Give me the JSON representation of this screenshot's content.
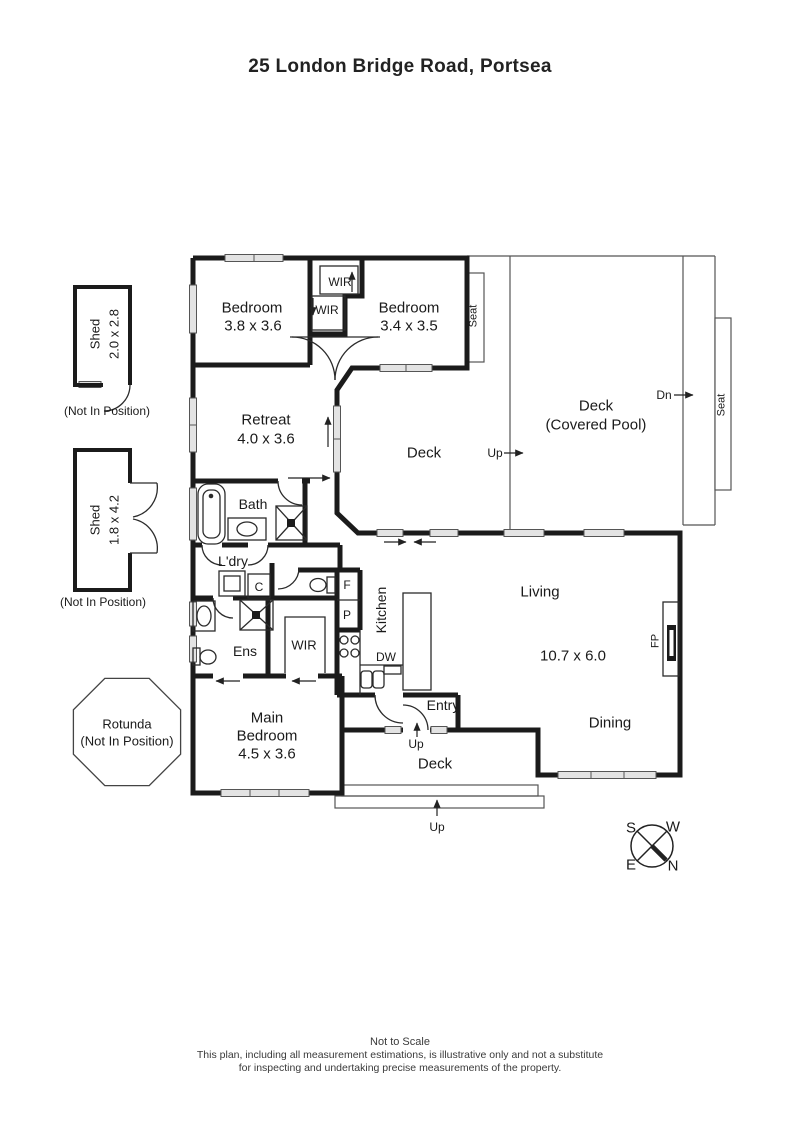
{
  "title": "25 London Bridge Road, Portsea",
  "colors": {
    "ink": "#1b1b1b"
  },
  "plan": {
    "labels": [
      {
        "name": "bedroom1-name",
        "text": "Bedroom",
        "x": 252,
        "y": 308,
        "size": 15
      },
      {
        "name": "bedroom1-dims",
        "text": "3.8 x 3.6",
        "x": 253,
        "y": 326,
        "size": 15
      },
      {
        "name": "wir-top-upper",
        "text": "WIR",
        "x": 340,
        "y": 282,
        "size": 12
      },
      {
        "name": "wir-top-lower",
        "text": "WIR",
        "x": 327,
        "y": 310,
        "size": 12
      },
      {
        "name": "bedroom2-name",
        "text": "Bedroom",
        "x": 409,
        "y": 308,
        "size": 15
      },
      {
        "name": "bedroom2-dims",
        "text": "3.4 x 3.5",
        "x": 409,
        "y": 326,
        "size": 15
      },
      {
        "name": "seat-top",
        "text": "Seat",
        "x": 474,
        "y": 316,
        "rot": -90,
        "size": 11
      },
      {
        "name": "deck-pool-name",
        "text": "Deck",
        "x": 596,
        "y": 406,
        "size": 15
      },
      {
        "name": "deck-pool-sub",
        "text": "(Covered Pool)",
        "x": 596,
        "y": 425,
        "size": 15
      },
      {
        "name": "dn-label",
        "text": "Dn",
        "x": 664,
        "y": 395,
        "size": 12
      },
      {
        "name": "seat-right",
        "text": "Seat",
        "x": 722,
        "y": 405,
        "rot": -90,
        "size": 11
      },
      {
        "name": "retreat-name",
        "text": "Retreat",
        "x": 266,
        "y": 420,
        "size": 15
      },
      {
        "name": "retreat-dims",
        "text": "4.0 x 3.6",
        "x": 266,
        "y": 439,
        "size": 15
      },
      {
        "name": "deck-middle",
        "text": "Deck",
        "x": 424,
        "y": 453,
        "size": 15
      },
      {
        "name": "up-middle",
        "text": "Up",
        "x": 495,
        "y": 453,
        "size": 12
      },
      {
        "name": "bath",
        "text": "Bath",
        "x": 253,
        "y": 504,
        "size": 14
      },
      {
        "name": "laundry",
        "text": "L'dry",
        "x": 233,
        "y": 561,
        "size": 14
      },
      {
        "name": "cupboard",
        "text": "C",
        "x": 259,
        "y": 587,
        "size": 12
      },
      {
        "name": "fridge",
        "text": "F",
        "x": 347,
        "y": 585,
        "size": 12
      },
      {
        "name": "pantry",
        "text": "P",
        "x": 347,
        "y": 615,
        "size": 12
      },
      {
        "name": "kitchen",
        "text": "Kitchen",
        "x": 381,
        "y": 610,
        "rot": -90,
        "size": 14
      },
      {
        "name": "dishwasher",
        "text": "DW",
        "x": 386,
        "y": 657,
        "size": 12
      },
      {
        "name": "wir-main",
        "text": "WIR",
        "x": 304,
        "y": 645,
        "size": 13
      },
      {
        "name": "ensuite",
        "text": "Ens",
        "x": 245,
        "y": 651,
        "size": 14
      },
      {
        "name": "main-bedroom-1",
        "text": "Main",
        "x": 267,
        "y": 718,
        "size": 15
      },
      {
        "name": "main-bedroom-2",
        "text": "Bedroom",
        "x": 267,
        "y": 736,
        "size": 15
      },
      {
        "name": "main-bedroom-dims",
        "text": "4.5 x 3.6",
        "x": 267,
        "y": 754,
        "size": 15
      },
      {
        "name": "entry",
        "text": "Entry",
        "x": 443,
        "y": 705,
        "size": 14
      },
      {
        "name": "up-entry",
        "text": "Up",
        "x": 416,
        "y": 744,
        "size": 12
      },
      {
        "name": "living",
        "text": "Living",
        "x": 540,
        "y": 592,
        "size": 15
      },
      {
        "name": "living-dims",
        "text": "10.7 x 6.0",
        "x": 573,
        "y": 656,
        "size": 15
      },
      {
        "name": "dining",
        "text": "Dining",
        "x": 610,
        "y": 723,
        "size": 15
      },
      {
        "name": "fireplace",
        "text": "FP",
        "x": 656,
        "y": 641,
        "rot": -90,
        "size": 11
      },
      {
        "name": "deck-bottom",
        "text": "Deck",
        "x": 435,
        "y": 764,
        "size": 15
      },
      {
        "name": "up-deck",
        "text": "Up",
        "x": 437,
        "y": 827,
        "size": 12
      },
      {
        "name": "shed1-name",
        "text": "Shed",
        "x": 95,
        "y": 334,
        "rot": -90,
        "size": 13
      },
      {
        "name": "shed1-dims",
        "text": "2.0 x 2.8",
        "x": 114,
        "y": 334,
        "rot": -90,
        "size": 13
      },
      {
        "name": "shed1-note",
        "text": "(Not In Position)",
        "x": 107,
        "y": 411,
        "size": 12
      },
      {
        "name": "shed2-name",
        "text": "Shed",
        "x": 95,
        "y": 520,
        "rot": -90,
        "size": 13
      },
      {
        "name": "shed2-dims",
        "text": "1.8 x 4.2",
        "x": 114,
        "y": 520,
        "rot": -90,
        "size": 13
      },
      {
        "name": "shed2-note",
        "text": "(Not In Position)",
        "x": 103,
        "y": 602,
        "size": 12
      },
      {
        "name": "rotunda-name",
        "text": "Rotunda",
        "x": 127,
        "y": 724,
        "size": 13
      },
      {
        "name": "rotunda-note",
        "text": "(Not In Position)",
        "x": 127,
        "y": 741,
        "size": 13
      },
      {
        "name": "compass-s",
        "text": "S",
        "x": 631,
        "y": 828,
        "size": 15
      },
      {
        "name": "compass-w",
        "text": "W",
        "x": 673,
        "y": 827,
        "size": 15
      },
      {
        "name": "compass-e",
        "text": "E",
        "x": 631,
        "y": 865,
        "size": 15
      },
      {
        "name": "compass-n",
        "text": "N",
        "x": 673,
        "y": 866,
        "size": 15
      }
    ]
  },
  "footer": {
    "scale_note": "Not to Scale",
    "disclaimer_line1": "This plan, including all measurement estimations, is illustrative only and not a substitute",
    "disclaimer_line2": "for inspecting and undertaking precise measurements of the property."
  }
}
